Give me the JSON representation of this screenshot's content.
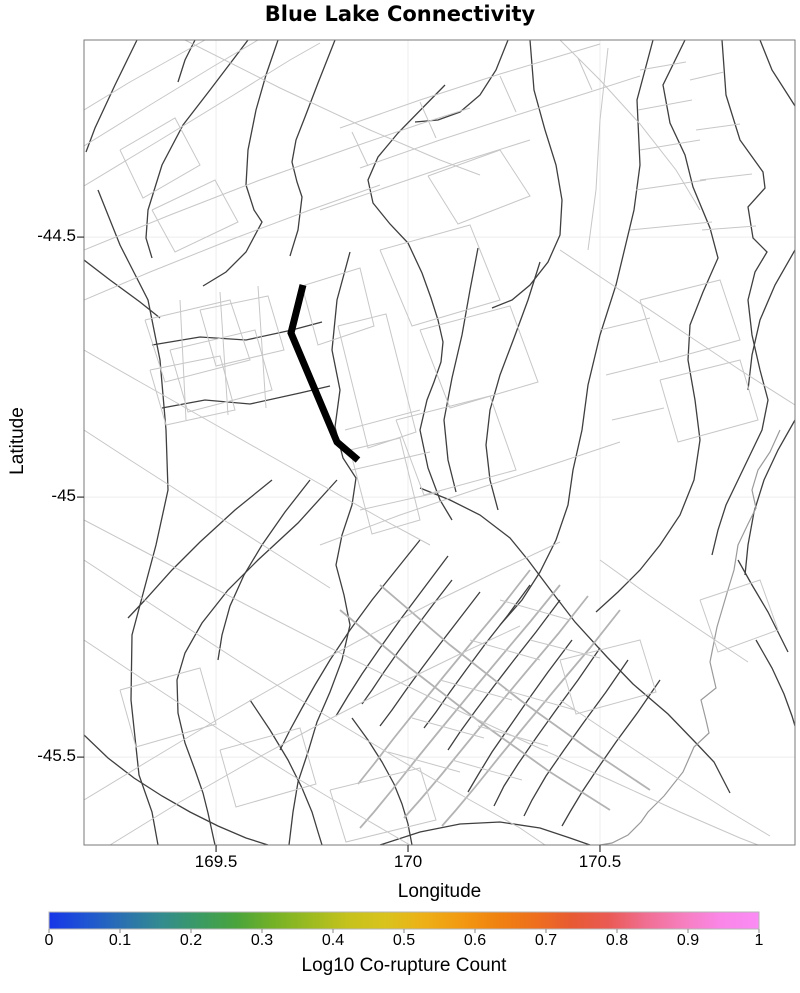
{
  "chart_data": {
    "type": "map",
    "title": "Blue Lake Connectivity",
    "xlabel": "Longitude",
    "ylabel": "Latitude",
    "x_range": [
      169.156,
      171.008
    ],
    "y_range": [
      -45.669,
      -44.121
    ],
    "x_ticks": {
      "values": [
        169.5,
        170.0,
        170.5
      ],
      "labels": [
        "169.5",
        "170",
        "170.5"
      ]
    },
    "y_ticks": {
      "values": [
        -44.5,
        -45.0,
        -45.5
      ],
      "labels": [
        "-44.5",
        "-45",
        "-45.5"
      ]
    },
    "grid": true,
    "colorbar": {
      "label": "Log10 Co-rupture Count",
      "tick_values": [
        0,
        0.1,
        0.2,
        0.3,
        0.4,
        0.5,
        0.6,
        0.7,
        0.8,
        0.9,
        1
      ],
      "tick_labels": [
        "0",
        "0.1",
        "0.2",
        "0.3",
        "0.4",
        "0.5",
        "0.6",
        "0.7",
        "0.8",
        "0.9",
        "1"
      ],
      "range": [
        0,
        1
      ],
      "colors": [
        "#1635e8",
        "#1f55d2",
        "#2a71b0",
        "#338b8f",
        "#3a9a64",
        "#49a43c",
        "#74b127",
        "#9cbb20",
        "#c6c21c",
        "#d9c31c",
        "#edb117",
        "#f29a12",
        "#f08210",
        "#ee6f1d",
        "#e85a33",
        "#ea5a55",
        "#f06f93",
        "#f67fc0",
        "#fa86e8",
        "#fb8cf4"
      ]
    },
    "highlighted_fault": {
      "name": "Blue Lake",
      "color": "#000000",
      "points_px": "303,285 291,333 337,442 358,460"
    },
    "fault_traces": {
      "coordinate_space": "figure pixels (plot area x 84-795, y 40-845)",
      "lines": [
        {
          "k": "dark",
          "p": "137,40 115,85 95,128 86,152"
        },
        {
          "k": "dark",
          "p": "98,190 120,245 148,300 160,360 166,430 168,490 156,545 132,635 131,700 139,775 152,812 158,845"
        },
        {
          "k": "dark",
          "p": "248,40 210,90 183,125 162,165 148,210 146,238 152,258"
        },
        {
          "k": "dark",
          "p": "278,40 266,75 256,110 248,150 246,185 254,210 262,222 246,252 226,272 203,286"
        },
        {
          "k": "dark",
          "p": "335,40 318,83 305,117 296,140 292,162 297,182 302,197 298,230 290,256"
        },
        {
          "k": "dark",
          "p": "350,252 337,300 332,350 340,390 335,427 343,458 356,478 352,505 342,535 336,565 344,595 350,625 342,660 330,692 317,722 308,752 298,782 293,812 289,845"
        },
        {
          "k": "dark",
          "p": "445,85 398,133 378,157 368,180 373,203 390,224 408,243 422,273 431,298 438,320 443,342 441,362 434,382 427,400 420,430 428,468 440,500 452,520"
        },
        {
          "k": "dark",
          "p": "508,40 496,70 480,95 460,112 438,120 415,122"
        },
        {
          "k": "dark",
          "p": "530,40 534,90 545,130 556,165 562,200 560,235 548,262 530,285 512,300 492,308"
        },
        {
          "k": "dark",
          "p": "653,40 637,100 640,165 634,210 616,285 600,335 588,385 582,430 573,470 568,505 556,540 540,572 522,600 500,625"
        },
        {
          "k": "dark",
          "p": "685,40 663,85 670,123 685,155 693,187 710,228 718,258 703,292 690,325 688,360 695,400 700,440 694,480 680,515 660,545 640,570 618,592 596,612"
        },
        {
          "k": "dark",
          "p": "722,40 726,95 740,140 763,172 765,188 748,207 753,238 767,252 755,272 748,300 752,335 760,370 768,400 762,430 750,455 738,480 726,505 718,530 712,555"
        },
        {
          "k": "dark",
          "p": "760,40 772,70 788,95 795,106"
        },
        {
          "k": "dark",
          "p": "420,488 450,500 480,515 510,538 528,560 552,592 575,622 607,657 633,684 668,714 696,743 714,762 730,793"
        },
        {
          "k": "dark",
          "p": "572,640 548,672 528,700 510,726 492,752 478,775 468,792"
        },
        {
          "k": "dark",
          "p": "600,648 578,680 556,710 536,738 518,764 504,786 494,806"
        },
        {
          "k": "dark",
          "p": "628,660 606,692 584,722 564,750 546,776 532,800 524,816"
        },
        {
          "k": "dark",
          "p": "560,600 536,632 514,660 494,686 476,710 460,732 448,750"
        },
        {
          "k": "dark",
          "p": "530,585 508,615 486,643 466,670 450,692 436,712 424,728"
        },
        {
          "k": "dark",
          "p": "660,680 638,712 616,742 598,768 582,792 570,812 562,826"
        },
        {
          "k": "dark",
          "p": "480,592 460,618 440,644 422,668 406,690 392,710 380,726"
        },
        {
          "k": "dark",
          "p": "452,580 432,606 414,630 398,652 384,672 372,690 362,704"
        },
        {
          "k": "dark",
          "p": "272,480 235,510 200,542 172,570 145,600 128,618"
        },
        {
          "k": "dark",
          "p": "337,480 298,523 258,560 228,590 202,623 185,653 177,680 178,713 185,743 195,770 203,793 208,813 215,845"
        },
        {
          "k": "dark",
          "p": "310,480 285,512 262,545 244,575 230,606 222,635 218,660"
        },
        {
          "k": "dark",
          "p": "420,540 396,570 372,600 350,630 330,660 315,685 302,708 290,730 280,750"
        },
        {
          "k": "dark",
          "p": "448,556 424,588 400,620 380,648 362,674 348,696 336,716"
        },
        {
          "k": "dark",
          "p": "84,735 108,758 134,778 162,796 190,812 218,826 246,838 268,845"
        },
        {
          "k": "dark",
          "p": "250,700 270,730 288,760 302,788 312,812 318,832 322,845"
        },
        {
          "k": "dark",
          "p": "152,345 200,337 246,340 292,330 322,322"
        },
        {
          "k": "dark",
          "p": "162,408 205,400 250,404 300,393 330,386"
        },
        {
          "k": "dark",
          "p": "478,248 470,290 462,335 452,378 444,420 448,460 456,492"
        },
        {
          "k": "dark",
          "p": "540,262 528,300 514,338 500,375 490,410 486,445 490,480 498,510"
        },
        {
          "k": "dark",
          "p": "795,250 775,285 760,320 752,355 748,390"
        },
        {
          "k": "dark",
          "p": "795,420 778,450 764,480 754,512 748,545 745,575"
        },
        {
          "k": "dark",
          "p": "738,560 752,585 768,612 780,636 788,652"
        },
        {
          "k": "dark",
          "p": "756,640 772,668 784,694 792,716 795,726"
        },
        {
          "k": "dark",
          "p": "380,845 420,832 460,824 500,822 540,828 570,838 590,845"
        },
        {
          "k": "dark",
          "p": "84,260 110,280 140,302 160,318"
        },
        {
          "k": "dark",
          "p": "195,40 185,60 178,82"
        },
        {
          "k": "dark",
          "p": "352,718 368,740 382,762 394,784 402,804 408,824 412,845"
        },
        {
          "k": "coast",
          "p": "780,430 770,452 758,470 752,490 756,508 748,524 738,545 734,570 727,593 717,627 710,662 716,688 701,700 706,720 709,733 694,747 683,772 664,796 648,812 641,822 628,835 612,843 600,845"
        },
        {
          "k": "mid",
          "p": "560,585 530,622 498,660 468,696 440,730 414,762 392,790 374,812 360,828"
        },
        {
          "k": "mid",
          "p": "588,596 558,634 526,672 496,708 468,742 442,774 420,800 404,818"
        },
        {
          "k": "mid",
          "p": "620,610 590,648 558,686 528,722 500,756 476,786 456,810 442,826"
        },
        {
          "k": "mid",
          "p": "530,570 502,606 472,642 444,676 418,708 394,738 374,764 358,784"
        },
        {
          "k": "mid",
          "p": "380,585 450,645 520,700 590,750 650,790"
        },
        {
          "k": "mid",
          "p": "340,610 410,668 480,722 550,772 610,810"
        },
        {
          "k": "light",
          "p": "84,146 150,105 214,66 258,40"
        },
        {
          "k": "light",
          "p": "84,186 160,140 232,96 290,60 320,43"
        },
        {
          "k": "light",
          "p": "84,110 130,82 180,54 205,40"
        },
        {
          "k": "light",
          "p": "120,150 175,118 200,165 143,198 120,150"
        },
        {
          "k": "light",
          "p": "152,210 215,180 238,222 175,252 152,210"
        },
        {
          "k": "light",
          "p": "185,40 280,88 370,130 440,160 480,175"
        },
        {
          "k": "light",
          "p": "84,250 170,215 260,180 350,148 420,124 470,108"
        },
        {
          "k": "light",
          "p": "84,300 150,272 230,240 310,210 380,185"
        },
        {
          "k": "light",
          "p": "340,128 420,100 500,74 560,56 600,44"
        },
        {
          "k": "light",
          "p": "360,168 440,140 520,114 590,92 640,76"
        },
        {
          "k": "light",
          "p": "352,132 368,166"
        },
        {
          "k": "light",
          "p": "420,102 436,138"
        },
        {
          "k": "light",
          "p": "500,76 516,112"
        },
        {
          "k": "light",
          "p": "578,58 592,90"
        },
        {
          "k": "light",
          "p": "428,176 500,150 530,196 458,224 428,176"
        },
        {
          "k": "light",
          "p": "320,210 390,186 460,162 530,140"
        },
        {
          "k": "light",
          "p": "640,70 686,62"
        },
        {
          "k": "light",
          "p": "638,110 692,100"
        },
        {
          "k": "light",
          "p": "640,150 700,140"
        },
        {
          "k": "light",
          "p": "636,190 706,180"
        },
        {
          "k": "light",
          "p": "630,230 712,222"
        },
        {
          "k": "light",
          "p": "608,48 600,120 596,190 588,250"
        },
        {
          "k": "light",
          "p": "690,80 724,72"
        },
        {
          "k": "light",
          "p": "696,130 740,124"
        },
        {
          "k": "light",
          "p": "700,180 752,174"
        },
        {
          "k": "light",
          "p": "702,230 756,226"
        },
        {
          "k": "light",
          "p": "560,40 600,80 640,124 676,170 700,210"
        },
        {
          "k": "light",
          "p": "145,320 230,300 250,360 165,382 145,320"
        },
        {
          "k": "light",
          "p": "170,350 255,330 272,390 188,412 170,350"
        },
        {
          "k": "light",
          "p": "200,310 268,296 284,350 216,366 200,310"
        },
        {
          "k": "light",
          "p": "150,370 220,356 235,410 166,425 150,370"
        },
        {
          "k": "light",
          "p": "180,300 186,420"
        },
        {
          "k": "light",
          "p": "220,292 228,415"
        },
        {
          "k": "light",
          "p": "258,286 266,408"
        },
        {
          "k": "light",
          "p": "302,286 360,268 374,326 318,345 302,286"
        },
        {
          "k": "light",
          "p": "338,326 386,314 416,432 368,448 338,326"
        },
        {
          "k": "light",
          "p": "350,450 400,438 420,520 372,534 350,450"
        },
        {
          "k": "light",
          "p": "380,250 470,225 500,300 412,326 380,250"
        },
        {
          "k": "light",
          "p": "420,330 510,306 538,382 450,408 420,330"
        },
        {
          "k": "light",
          "p": "396,420 490,396 516,470 424,495 396,420"
        },
        {
          "k": "light",
          "p": "345,430 420,410"
        },
        {
          "k": "light",
          "p": "352,470 430,452"
        },
        {
          "k": "light",
          "p": "360,510 440,492"
        },
        {
          "k": "light",
          "p": "320,545 400,515 480,488 560,462 620,442"
        },
        {
          "k": "light",
          "p": "640,300 720,280 740,340 660,362 640,300"
        },
        {
          "k": "light",
          "p": "660,380 740,360 758,420 678,442 660,380"
        },
        {
          "k": "light",
          "p": "600,330 650,318"
        },
        {
          "k": "light",
          "p": "606,375 658,362"
        },
        {
          "k": "light",
          "p": "612,420 664,408"
        },
        {
          "k": "light",
          "p": "560,250 620,290 680,330 740,370 795,405"
        },
        {
          "k": "light",
          "p": "84,560 160,610 240,662 320,712 400,760 470,800 520,828 545,845"
        },
        {
          "k": "light",
          "p": "84,640 150,684 220,730 290,774 360,816 410,845"
        },
        {
          "k": "light",
          "p": "84,520 170,565 260,612 350,658 440,702 530,744 610,780 680,812 740,838 758,845"
        },
        {
          "k": "light",
          "p": "84,800 150,760 220,718 290,678 360,640 430,604 500,570 560,542"
        },
        {
          "k": "light",
          "p": "110,845 180,802 250,762 320,724 390,688 460,654 520,626"
        },
        {
          "k": "light",
          "p": "120,690 200,668 216,724 136,747 120,690"
        },
        {
          "k": "light",
          "p": "220,750 300,728 316,784 236,807 220,750"
        },
        {
          "k": "light",
          "p": "470,640 540,660"
        },
        {
          "k": "light",
          "p": "440,680 512,700"
        },
        {
          "k": "light",
          "p": "412,718 484,738"
        },
        {
          "k": "light",
          "p": "388,752 460,772"
        },
        {
          "k": "light",
          "p": "500,600 570,620"
        },
        {
          "k": "light",
          "p": "530,640 600,658"
        },
        {
          "k": "light",
          "p": "505,690 575,710"
        },
        {
          "k": "light",
          "p": "478,726 548,746"
        },
        {
          "k": "light",
          "p": "452,760 522,780"
        },
        {
          "k": "light",
          "p": "700,600 760,580 778,630 718,652 700,600"
        },
        {
          "k": "light",
          "p": "560,700 620,740 680,780 730,812 770,836"
        },
        {
          "k": "light",
          "p": "600,560 650,596 700,630 748,662"
        },
        {
          "k": "light",
          "p": "84,430 130,460 180,492 230,524 280,556 330,588"
        },
        {
          "k": "light",
          "p": "84,350 140,382 200,416 260,450 320,484 380,518 430,545"
        },
        {
          "k": "light",
          "p": "330,790 420,768 436,820 346,842 330,790"
        },
        {
          "k": "light",
          "p": "560,660 640,640 656,692 576,714 560,660"
        }
      ]
    }
  }
}
